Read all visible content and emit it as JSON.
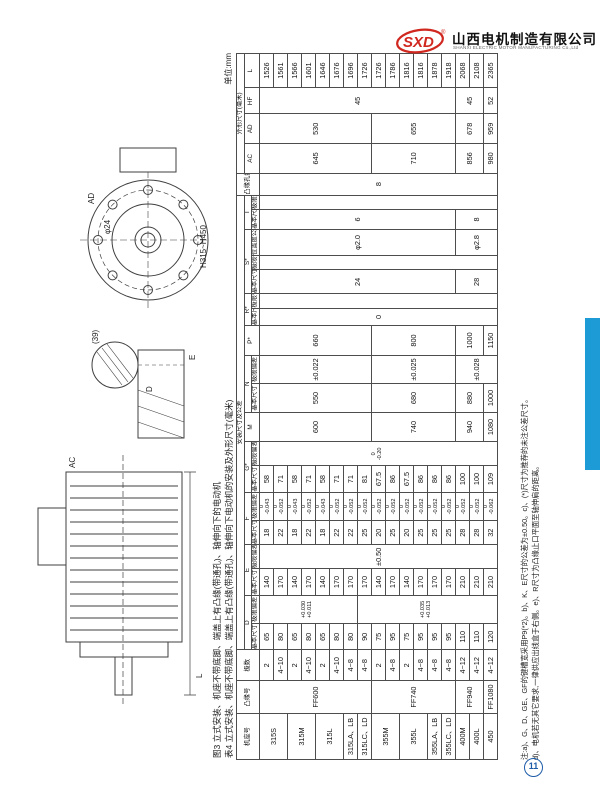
{
  "page": {
    "unit_label": "单位:mm",
    "page_number": "11",
    "accent_blue": "#1d9bd7",
    "stamp_blue": "#1d5ca8",
    "logo_red": "#d0271f"
  },
  "logo": {
    "mark": "SXD",
    "registered": "®",
    "company_cn": "山西电机制造有限公司",
    "company_en": "SHANXI ELECTRIC MOTOR MANUFACTURING Co.,Ltd"
  },
  "captions": {
    "figure": "图3  立式安装、机座不带底脚、端盖上有凸缘(带通孔)、轴伸向下的电动机",
    "table": "表4  立式安装、机座不带底脚、端盖上有凸缘(带通孔)、轴伸向下电动机的安装及外形尺寸(毫米)"
  },
  "drawing_labels": {
    "ac": "AC",
    "l": "L",
    "ad": "AD",
    "d": "D",
    "e": "E",
    "detail": "(39)",
    "hole": "φ24",
    "range": "H315~H450"
  },
  "notes": {
    "line1": "注:a)、G、D、GE、GF的键槽宽采用P9(*2)。b)、K、E尺寸的公差为±0.50。c)、(*)尺寸为推荐的未注公差尺寸。",
    "line2": "d)、电机若无其它要求,一律供应出线盒于右侧。e)、R尺寸为凸缘止口平面至轴伸肩的距离。"
  },
  "table": {
    "group_headers": {
      "frame": "机座号",
      "flange": "凸缘号",
      "poles": "极数",
      "mounting": "安装尺寸及公差",
      "holes": "凸缘孔数",
      "outline": "外形尺寸(毫米)"
    },
    "sub_headers": {
      "basic": "基本|尺寸",
      "limit": "极限|偏差",
      "position": "位置度|公差"
    },
    "letters": [
      "D",
      "E",
      "F",
      "G*",
      "M",
      "N",
      "P*",
      "R*",
      "S*",
      "T",
      "AC",
      "AD",
      "HF",
      "L"
    ],
    "header_spec": [
      [
        {
          "t": "机座号",
          "rs": 3
        },
        {
          "t": "凸缘号",
          "rs": 3
        },
        {
          "t": "极数",
          "rs": 3
        },
        {
          "t": "安装尺寸及公差",
          "cs": 19
        },
        {
          "t": "凸缘|孔数",
          "rs": 3
        },
        {
          "t": "外形尺寸(毫米)",
          "cs": 4
        }
      ],
      [
        {
          "t": "D",
          "cs": 2
        },
        {
          "t": "E",
          "cs": 2
        },
        {
          "t": "F",
          "cs": 2
        },
        {
          "t": "G*",
          "cs": 2
        },
        {
          "t": "M",
          "rs": 2
        },
        {
          "t": "N",
          "cs": 2
        },
        {
          "t": "P*",
          "rs": 2
        },
        {
          "t": "R*",
          "cs": 2
        },
        {
          "t": "S*",
          "cs": 3
        },
        {
          "t": "T",
          "cs": 2
        },
        {
          "t": "AC",
          "rs": 2
        },
        {
          "t": "AD",
          "rs": 2
        },
        {
          "t": "HF",
          "rs": 2
        },
        {
          "t": "L",
          "rs": 2
        }
      ],
      [
        {
          "t": "基本|尺寸"
        },
        {
          "t": "极限|偏差"
        },
        {
          "t": "基本|尺寸"
        },
        {
          "t": "极限|偏差"
        },
        {
          "t": "基本|尺寸"
        },
        {
          "t": "极限|偏差"
        },
        {
          "t": "基本|尺寸"
        },
        {
          "t": "极限|偏差"
        },
        {
          "t": "基本|尺寸"
        },
        {
          "t": "极限|偏差"
        },
        {
          "t": "基本|尺寸"
        },
        {
          "t": "极限|偏差"
        },
        {
          "t": "基本|尺寸"
        },
        {
          "t": "极限|偏差"
        },
        {
          "t": "位置度|公差"
        },
        {
          "t": "基本|尺寸"
        },
        {
          "t": "极限|偏差"
        }
      ]
    ],
    "rows": [
      [
        {
          "t": "315S",
          "rs": 2
        },
        {
          "t": "FF600",
          "rs": 8
        },
        "2",
        "65",
        {
          "t": "+0.030|+0.011",
          "rs": 7
        },
        "140",
        {
          "t": "±0.50",
          "rs": 17
        },
        "18",
        "0|-0.043",
        "58",
        {
          "t": "0|-0.20",
          "rs": 17
        },
        {
          "t": "600",
          "rs": 8
        },
        {
          "t": "550",
          "rs": 8
        },
        {
          "t": "±0.022",
          "rs": 8
        },
        {
          "t": "660",
          "rs": 8
        },
        {
          "t": "0",
          "rs": 17
        },
        {
          "t": "",
          "rs": 17
        },
        {
          "t": "24",
          "rs": 14
        },
        {
          "t": "",
          "rs": 17
        },
        {
          "t": "φ2.0",
          "rs": 14
        },
        {
          "t": "6",
          "rs": 14
        },
        {
          "t": "",
          "rs": 17
        },
        {
          "t": "8",
          "rs": 17
        },
        {
          "t": "645",
          "rs": 8
        },
        {
          "t": "530",
          "rs": 8
        },
        {
          "t": "45",
          "rs": 14
        },
        "1526"
      ],
      [
        "4~10",
        "80",
        "170",
        "22",
        "0|-0.052",
        "71",
        "1561"
      ],
      [
        {
          "t": "315M",
          "rs": 2
        },
        "2",
        "65",
        "140",
        "18",
        "0|-0.043",
        "58",
        "1566"
      ],
      [
        "4~10",
        "80",
        "170",
        "22",
        "0|-0.052",
        "71",
        "1601"
      ],
      [
        {
          "t": "315L",
          "rs": 2
        },
        "2",
        "65",
        "140",
        "18",
        "0|-0.043",
        "58",
        "1646"
      ],
      [
        "4~10",
        "80",
        "170",
        "22",
        "0|-0.052",
        "71",
        "1676"
      ],
      [
        "315LA、LB",
        "4~8",
        "80",
        "170",
        "22",
        "0|-0.052",
        "71",
        "1696"
      ],
      [
        "315LC、LD",
        "4~8",
        "90",
        {
          "t": "+0.035|+0.013",
          "rs": 10
        },
        "170",
        "25",
        "0|-0.052",
        "81",
        "1726"
      ],
      [
        {
          "t": "355M",
          "rs": 2
        },
        {
          "t": "FF740",
          "rs": 6
        },
        "2",
        "75",
        "140",
        "20",
        "0|-0.052",
        "67.5",
        {
          "t": "740",
          "rs": 6
        },
        {
          "t": "680",
          "rs": 6
        },
        {
          "t": "±0.025",
          "rs": 6
        },
        {
          "t": "800",
          "rs": 6
        },
        {
          "t": "710",
          "rs": 6
        },
        {
          "t": "655",
          "rs": 6
        },
        "1726"
      ],
      [
        "4~8",
        "95",
        "170",
        "25",
        "0|-0.052",
        "86",
        "1786"
      ],
      [
        {
          "t": "355L",
          "rs": 2
        },
        "2",
        "75",
        "140",
        "20",
        "0|-0.052",
        "67.5",
        "1816"
      ],
      [
        "4~8",
        "95",
        "170",
        "25",
        "0|-0.052",
        "86",
        "1816"
      ],
      [
        "355LA、LB",
        "4~8",
        "95",
        "170",
        "25",
        "0|-0.052",
        "86",
        "1878"
      ],
      [
        "355LC、LD",
        "4~8",
        "95",
        "170",
        "25",
        "0|-0.052",
        "86",
        "1918"
      ],
      [
        "400M",
        {
          "t": "FF940",
          "rs": 2
        },
        "4~12",
        "110",
        "210",
        "28",
        "0|-0.052",
        "100",
        {
          "t": "940",
          "rs": 2
        },
        {
          "t": "880",
          "rs": 2
        },
        {
          "t": "±0.028",
          "rs": 3
        },
        {
          "t": "1000",
          "rs": 2
        },
        {
          "t": "28",
          "rs": 3
        },
        {
          "t": "φ2.8",
          "rs": 3
        },
        {
          "t": "8",
          "rs": 3
        },
        {
          "t": "856",
          "rs": 2
        },
        {
          "t": "678",
          "rs": 2
        },
        {
          "t": "45",
          "rs": 2
        },
        "2068"
      ],
      [
        "400L",
        "4~12",
        "110",
        "210",
        "28",
        "0|-0.052",
        "100",
        "2108"
      ],
      [
        "450",
        "FF1080",
        "4~12",
        "120",
        "210",
        "32",
        "0|-0.062",
        "109",
        "1080",
        "1000",
        "1150",
        "980",
        "959",
        "52",
        "2365"
      ]
    ]
  }
}
